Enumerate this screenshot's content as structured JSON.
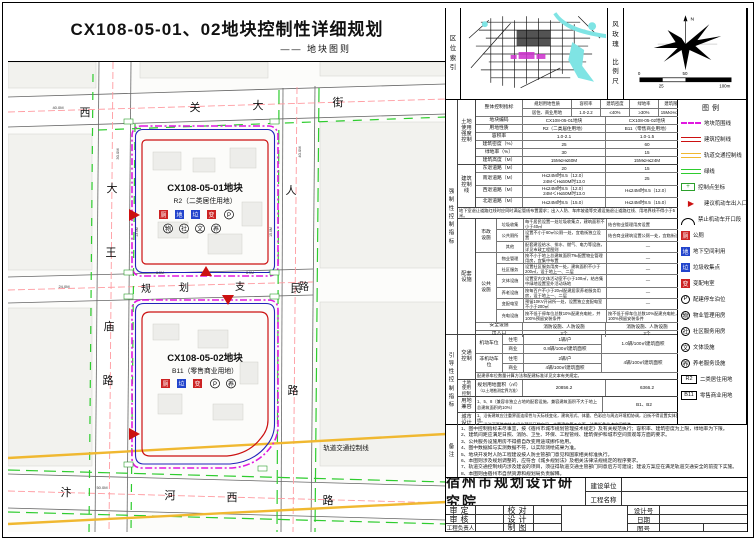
{
  "title": {
    "main": "CX108-05-01、02地块控制性详细规划",
    "sub": "—— 地块图则"
  },
  "panels": {
    "location": "区位索引",
    "wind": "风玫瑰",
    "scale": "比例尺",
    "north": "N",
    "scale0": "0",
    "scale50": "50",
    "scale25": "25",
    "scale100": "100m"
  },
  "strips": {
    "mandatory": "强制性控制指标",
    "guiding": "引导性控制指标",
    "remarks": "备注"
  },
  "map": {
    "roads": {
      "top": "西关大街",
      "left": "大王庙路",
      "mid": "规划支路",
      "right": "人民路",
      "bottom": "汴河西路",
      "rail": "轨道交通控制线"
    },
    "parcels": [
      {
        "name": "CX108-05-01地块",
        "use": "R2（二类居住用地）",
        "badges1": [
          "厕",
          "地",
          "垃",
          "变",
          "P"
        ],
        "badges2": [
          "物",
          "社",
          "文",
          "养"
        ]
      },
      {
        "name": "CX108-05-02地块",
        "use": "B11（零售商业用地）",
        "badges1": [
          "厕",
          "垃",
          "变",
          "P",
          "养"
        ]
      }
    ],
    "dims": {
      "top": "40.0M",
      "left": "30.0M",
      "right": "40.0M",
      "bottom": "50.0M",
      "mid": "24.0M",
      "s1": "8.5M",
      "s2": "8.5M",
      "s3": "13.0M",
      "s4": "15.0M"
    }
  },
  "table": {
    "header": {
      "group": "整体控制指标",
      "cols": [
        "规划用地性质",
        "容积率",
        "建筑密度",
        "绿地率",
        "建筑限高"
      ],
      "vals": [
        "居住、商业用地",
        "1.0-2.2",
        "≤40%",
        "≥30%",
        "15M≤H≤60M"
      ]
    },
    "intensity": {
      "group": "土地使用强度控制",
      "rows": [
        {
          "label": "地块编码",
          "v1": "CX108-05-01地块",
          "v2": "CX108-05-02地块"
        },
        {
          "label": "用地性质",
          "v1": "R2（二类居住用地）",
          "v2": "B11（零售商业用地）"
        },
        {
          "label": "容积率",
          "v1": "1.0-2.1",
          "v2": "1.0-1.5"
        },
        {
          "label": "建筑密度（%）",
          "v1": "25",
          "v2": "60"
        },
        {
          "label": "绿地率（%）",
          "v1": "30",
          "v2": "15"
        },
        {
          "label": "建筑高度（M）",
          "v1": "15M≤H≤60M",
          "v2": "15M≤H≤24M"
        }
      ]
    },
    "setback": {
      "group": "建筑控制线",
      "rows": [
        {
          "label": "东退道路（M）",
          "v1": "20",
          "v2": "15"
        },
        {
          "label": "南退道路（M）",
          "v1": "H≤24M时8.5（12.0）\n24M＜H≤60M时13.0",
          "v2": "25"
        },
        {
          "label": "西退道路（M）",
          "v1": "H≤24M时8.5（12.0）\n24M＜H≤60M时13.0",
          "v2": "H≤24M时8.5（12.0）"
        },
        {
          "label": "北退道路（M）",
          "v1": "H≤24M时8.5（15.0）",
          "v2": "H≤24M时8.5（15.0）"
        }
      ],
      "note": "地下室退让道路红线时应同时满足管线布置要求；出入人防、车库坡道等交通设施退让道路红线、用地界线不得小于5米。"
    },
    "facilities": {
      "group": "配套设施",
      "municipal": {
        "label": "市政设施",
        "rows": [
          {
            "sub": "垃圾收集",
            "v1": "每千居民设置一处垃圾收集点，建筑面积不小于40㎡",
            "v2": "结合物业管理用房设置"
          },
          {
            "sub": "公共厕所",
            "v1": "设置不小于60㎡公厕一处，宜临街独立设置",
            "v2": "结合商业建筑设置公厕一处，宜临街设置"
          },
          {
            "sub": "其他",
            "v1": "配套建设给水、排水、燃气、电力等设施，详见市政工程图则",
            "v2": "—"
          }
        ]
      },
      "public": {
        "label": "公共设施",
        "rows": [
          {
            "sub": "物业管理",
            "v1": "按不小于地上总建筑面积7‰配置物业管理用房，宜集中布置",
            "v2": "—"
          },
          {
            "sub": "社区服务",
            "v1": "设置社区服务用房一处，建筑面积不小于200㎡，设于地上一、二层",
            "v2": "—"
          },
          {
            "sub": "文体设施",
            "v1": "设置室内文体活动室不小于100㎡，结合集中绿地设置室外活动场地",
            "v2": "—"
          },
          {
            "sub": "养老设施",
            "v1": "按每百户不小于20㎡配建居家养老服务用房，设于地上一、二层",
            "v2": "—"
          },
          {
            "sub": "变配电室",
            "v1": "预留10KV开闭所一处，设置独立变配电室不小于200㎡",
            "v2": "—"
          },
          {
            "sub": "充电设施",
            "v1": "按不低于停车位总数10%配建充电桩，并100%预留安装条件",
            "v2": "按不低于停车位总数10%配建充电桩，并100%预留安装条件"
          }
        ]
      },
      "safety": {
        "label": "安全设施",
        "v1": "消防设施、人防设施",
        "v2": "消防设施、人防设施"
      },
      "entry": {
        "label": "出入口",
        "v1": "2个",
        "v2": "2个"
      }
    },
    "traffic": {
      "group": "交通控制",
      "motor": {
        "label": "机动车位",
        "subs": [
          {
            "sub": "住宅",
            "v": "1辆/户"
          },
          {
            "sub": "商业",
            "v": "0.8辆/100㎡建筑面积"
          }
        ],
        "v2": "1.0辆/100㎡建筑面积"
      },
      "nonmotor": {
        "label": "非机动车位",
        "subs": [
          {
            "sub": "住宅",
            "v": "2辆/户"
          },
          {
            "sub": "商业",
            "v": "4辆/100㎡建筑面积"
          }
        ],
        "v2": "4辆/100㎡建筑面积"
      },
      "note": "配建停车位数量计算方法和配建标准详见文本有关规定。"
    },
    "landuse": {
      "group": "土地使用控制",
      "label": "规划用地面积（㎡）",
      "sublabel": "（以土地勘测定界为准）",
      "v1": "20856.2",
      "v2": "6366.2"
    },
    "compat": {
      "group": "用地兼容",
      "v1": "1、5、8（兼容非独立占地的配套设施，兼容建筑面积不大于地上总建筑面积的10%）",
      "v2": "B1、B2"
    },
    "urban": {
      "group": "城市设计",
      "text": "1、沿街建筑应注重界面连续性与天际线变化，建筑形式、体量、色彩应与周边环境相协调，沿街不得设置实体围墙。\n2、沿汴河西路宜结合绿化预留开敞空间，丰富建筑第五立面，注重街角节点空间塑造。"
    }
  },
  "legend": {
    "title": "图例",
    "items": [
      {
        "icon": "parcel-line",
        "label": "地块范围线"
      },
      {
        "icon": "building-line",
        "label": "建筑控制线"
      },
      {
        "icon": "rail-line",
        "label": "轨道交通控制线"
      },
      {
        "icon": "green-line",
        "label": "绿线"
      },
      {
        "icon": "control-point",
        "char": "+",
        "label": "控制点坐标"
      },
      {
        "icon": "entrance",
        "char": "▶",
        "label": "建议机动车出入口"
      },
      {
        "icon": "no-opening",
        "label": "禁止机动车开口段"
      },
      {
        "icon": "sq-red",
        "char": "厕",
        "label": "公厕"
      },
      {
        "icon": "sq-blue",
        "char": "地",
        "label": "地下空间利用"
      },
      {
        "icon": "sq-blue",
        "char": "垃",
        "label": "垃圾收集点"
      },
      {
        "icon": "sq-red",
        "char": "变",
        "label": "变配电室"
      },
      {
        "icon": "circle",
        "char": "P",
        "label": "配建停车泊位"
      },
      {
        "icon": "circle",
        "char": "物",
        "label": "物业管理用房"
      },
      {
        "icon": "circle",
        "char": "社",
        "label": "社区服务用房"
      },
      {
        "icon": "circle",
        "char": "文",
        "label": "文体设施"
      },
      {
        "icon": "circle",
        "char": "养",
        "label": "养老服务设施"
      },
      {
        "icon": "code",
        "char": "R2",
        "label": "二类居住用地"
      },
      {
        "icon": "code",
        "char": "B11",
        "label": "零售商业用地"
      }
    ]
  },
  "notes": {
    "items": [
      "1、图中控制指标未尽事宜，按《宿州市城市规划管理技术规定》及有关规范执行；容积率、建筑密度为上限，绿地率为下限。",
      "2、建筑间距应满足日照、消防、卫生、环保、工程管线、建筑保护和城市空间景观等方面的要求。",
      "3、公共服务设施用房不得擅自改变用途或挪作他用。",
      "4、图中数据如与实测数据不符，以实际测绘成果为准。",
      "5、地块开发时人防工程建设按人防主管部门意见和国家相关标准执行。",
      "6、本图则涉及规划调整的，应符合《城乡规划法》及相关法律法规规定的程序要求。",
      "7、轨道交通控制线内涉及建设的项目，须征得轨道交通主管部门同意后方可建设；建设方案应在满足轨道交通安全的前提下实施。",
      "8、本图则由宿州市自然资源和规划局负责解释。"
    ]
  },
  "titleblock": {
    "institute": "宿州市规划设计研究院",
    "owner": "建设单位",
    "project": "工程名称",
    "approve": "审定",
    "proof": "校对",
    "review": "审核",
    "design": "设计",
    "lead": "工程负责人",
    "draft": "制图",
    "design_no": "设计号",
    "date": "日期",
    "sheet_no": "图号"
  },
  "colors": {
    "parcel": "#e018e0",
    "building": "#cc1111",
    "rail": "#f0b830",
    "green": "#2ecc2e",
    "blue": "#2222bb"
  }
}
